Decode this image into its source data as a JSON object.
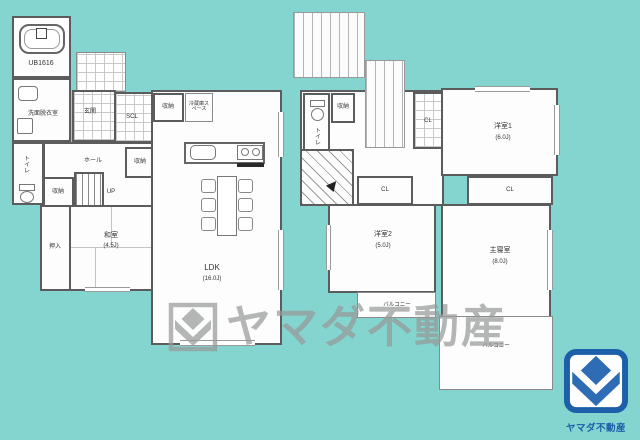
{
  "watermark": {
    "text": "ヤマダ不動産"
  },
  "logo": {
    "text": "ヤマダ不動産"
  },
  "colors": {
    "background": "#84d4d0",
    "wall": "#5c5c5c",
    "logo_blue": "#1d5fa9",
    "logo_mark_blue": "#2e6db6",
    "watermark_gray": "#979b98"
  },
  "floor1": {
    "bath_label": "UB1616",
    "washroom_label": "洗面脱衣室",
    "toilet_label": "トイレ",
    "genkan_label": "玄関",
    "scl_label": "SCL",
    "storage_kitchen_label": "収納",
    "fridge_label": "冷蔵庫スペース",
    "hall_label": "ホール",
    "storage_mid_label": "収納",
    "storage_hall_label": "収納",
    "stairs_label": "UP",
    "oshiire_label": "押入",
    "washitsu_label": "和室",
    "washitsu_size": "(4.5J)",
    "ldk_label": "LDK",
    "ldk_size": "(16.0J)"
  },
  "floor2": {
    "toilet_label": "トイレ",
    "storage_label": "収納",
    "closet_vertical_label": "CL",
    "closet1_label": "CL",
    "closet2_label": "CL",
    "room1_label": "洋室1",
    "room1_size": "(6.0J)",
    "room2_label": "洋室2",
    "room2_size": "(5.0J)",
    "master_label": "主寝室",
    "master_size": "(8.0J)",
    "balcony1_label": "バルコニー",
    "balcony2_label": "バルコニー"
  }
}
